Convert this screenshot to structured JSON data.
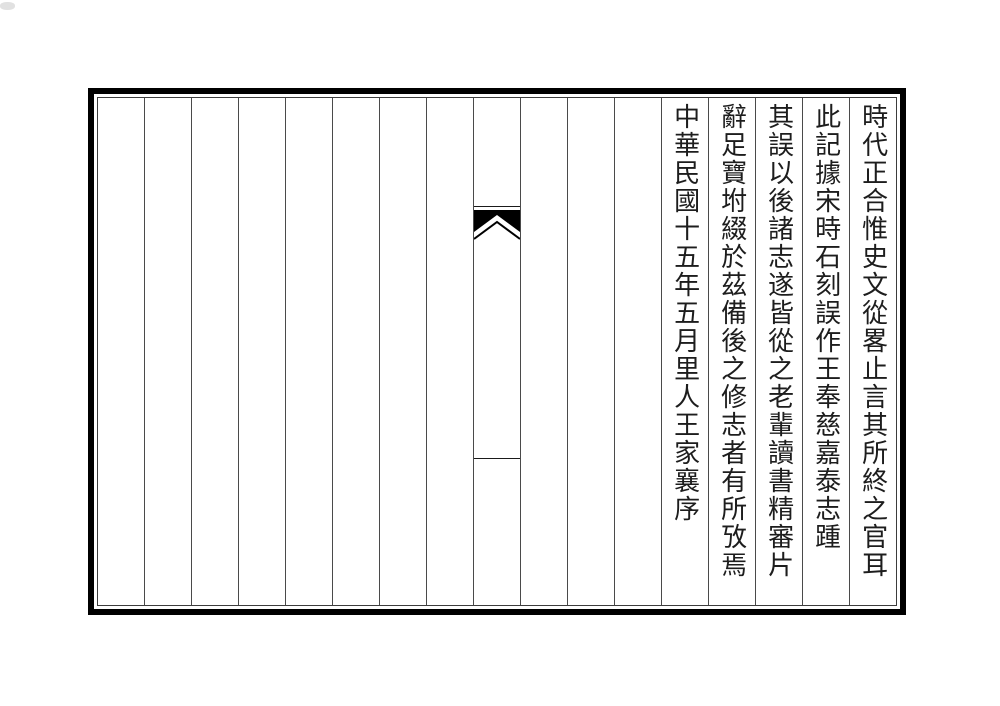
{
  "page": {
    "background_color": "#ffffff",
    "border_color": "#000000",
    "rule_color": "#4a4a4a",
    "text_color": "#1d1d1d"
  },
  "folio": {
    "columns_total": 17,
    "reading_direction": "vertical-right-to-left",
    "text_columns": [
      "時代正合惟史文從畧止言其所終之官耳",
      "此記據宋時石刻誤作王奉慈嘉泰志踵",
      "其誤以後諸志遂皆從之老輩讀書精審片",
      "辭足寶坿綴於茲備後之修志者有所攷焉",
      "中華民國十五年五月里人王家襄序"
    ],
    "center_column": {
      "mark": "fishtail"
    }
  }
}
